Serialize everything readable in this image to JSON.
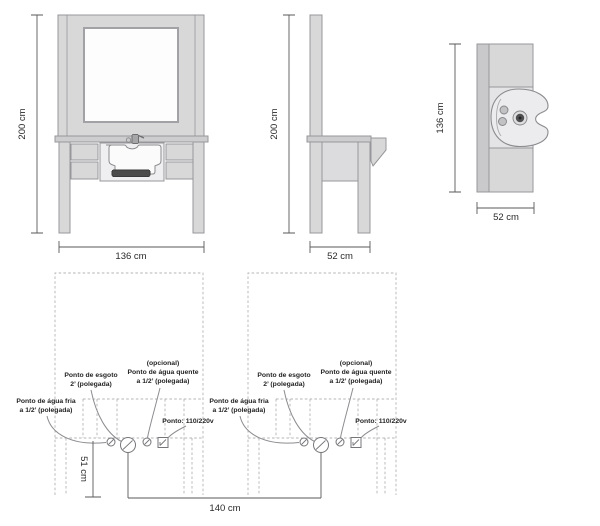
{
  "views": {
    "front": {
      "height": "200 cm",
      "width": "136 cm"
    },
    "side": {
      "height": "200 cm",
      "width": "52 cm"
    },
    "top": {
      "depth": "136 cm",
      "width": "52 cm"
    }
  },
  "plan": {
    "cold_water": {
      "line1": "Ponto de água fria",
      "line2": "a 1/2’ (polegada)"
    },
    "drain": {
      "line1": "Ponto de esgoto",
      "line2": "2’ (polegada)"
    },
    "hot_water": {
      "line1": "(opcional)",
      "line2": "Ponto de água quente",
      "line3": "a 1/2’ (polegada)"
    },
    "power": {
      "label": "Ponto: 110/220v"
    },
    "dims": {
      "height_from_floor": "51 cm",
      "between_centers": "140 cm"
    }
  },
  "colors": {
    "cabinet_fill": "#d8d8d8",
    "dark_bar": "#4b4b4b",
    "outline": "#97979b",
    "dashed_line": "#b4b4b6",
    "dimension_line": "#58585a",
    "text": "#232323"
  }
}
